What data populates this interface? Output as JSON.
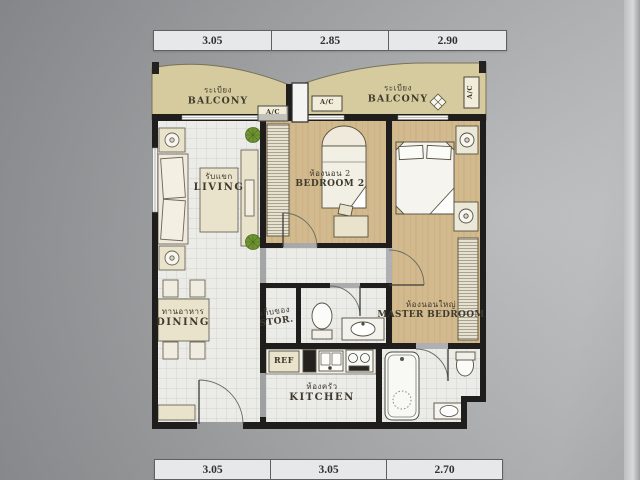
{
  "dimensions": {
    "top": [
      "3.05",
      "2.85",
      "2.90"
    ],
    "bottom": [
      "3.05",
      "3.05",
      "2.70"
    ]
  },
  "labels": {
    "ac": "A/C",
    "ref": "REF",
    "balcony_left": {
      "thai": "ระเบียง",
      "en": "BALCONY"
    },
    "balcony_right": {
      "thai": "ระเบียง",
      "en": "BALCONY"
    },
    "living": {
      "thai": "รับแขก",
      "en": "LIVING"
    },
    "bedroom2": {
      "thai": "ห้องนอน 2",
      "en": "BEDROOM 2"
    },
    "master_bedroom": {
      "thai": "ห้องนอนใหญ่",
      "en": "MASTER BEDROOM"
    },
    "dining": {
      "thai": "ทานอาหาร",
      "en": "DINING"
    },
    "storage": {
      "thai": "เก็บของ",
      "en": "STOR."
    },
    "kitchen": {
      "thai": "ห้องครัว",
      "en": "KITCHEN"
    }
  },
  "colors": {
    "balcony_khaki": "#d5cb9e",
    "wood_floor": "#d2ba8e",
    "wall_black": "#1f1e1c",
    "tile_floor": "#ebebe7",
    "furniture_cream": "#e9e3cc",
    "plant_green": "#6f9431",
    "photo_gray": "#a8aaac"
  }
}
